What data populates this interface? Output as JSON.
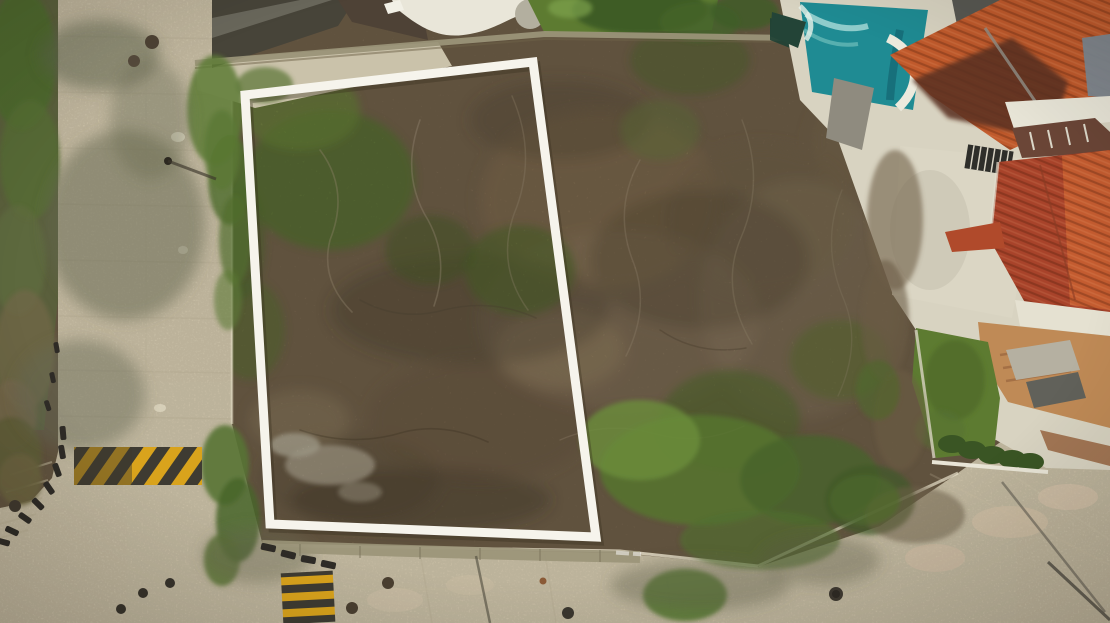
{
  "meta": {
    "type": "aerial-drone-photo",
    "subject": "Aerial drone view of a vacant scrubland corner lot outlined with a white property-boundary rectangle, bordered by pale concrete streets with yellow speed bumps, next to a neighboring house with red clay-tile roofs, terraces, lawn and a turquoise swimming pool"
  },
  "boundary": {
    "label": "property-boundary",
    "points": "245,95 533,62 596,537 270,524",
    "stroke_width": 9
  },
  "colors": {
    "pavement": "#d7ccb1",
    "lot_base": "#7b6950",
    "scrub_green": "#5d7a33",
    "boundary_white": "#f6f4ec",
    "pool_teal": "#1f8b93",
    "roof_red": "#c05a2c",
    "roof_red_dark": "#a8432a",
    "roof_shadow": "#5c3120",
    "lawn_green": "#5d7b31",
    "patio_terracotta": "#bf8a56",
    "bump_yellow": "#d9a31c",
    "bump_dark": "#3e3b32",
    "curb_dark": "#2e2b26",
    "wall_concrete": "#9a9478"
  },
  "scene": {
    "regions": [
      {
        "name": "vacant-lot",
        "desc": "dry brown scrubland with bare branches and scattered green brush"
      },
      {
        "name": "street-left",
        "desc": "pale concrete street running vertically on the left with tree shadows and manholes"
      },
      {
        "name": "street-bottom",
        "desc": "pale concrete street along the bottom edge with overhanging trees"
      },
      {
        "name": "side-street-corner",
        "desc": "curved lower-left corner with dark curb stones and stepped sidewalk"
      },
      {
        "name": "speed-bump-left",
        "desc": "yellow and black diagonally striped speed bump on the left street"
      },
      {
        "name": "speed-bump-bottom",
        "desc": "yellow and black striped speed bump on the bottom street"
      },
      {
        "name": "retaining-wall",
        "desc": "low concrete retaining wall along the lot's street edge"
      },
      {
        "name": "top-structures",
        "desc": "palapa roof, white curved deck and green lawn above the lot"
      },
      {
        "name": "swimming-pool",
        "desc": "turquoise pool with white curved rim at top right"
      },
      {
        "name": "neighbor-house",
        "desc": "house with red clay-tile hip roofs, white terraces, terracotta patio, garden lawn, hedge and driveway on the right"
      }
    ]
  }
}
